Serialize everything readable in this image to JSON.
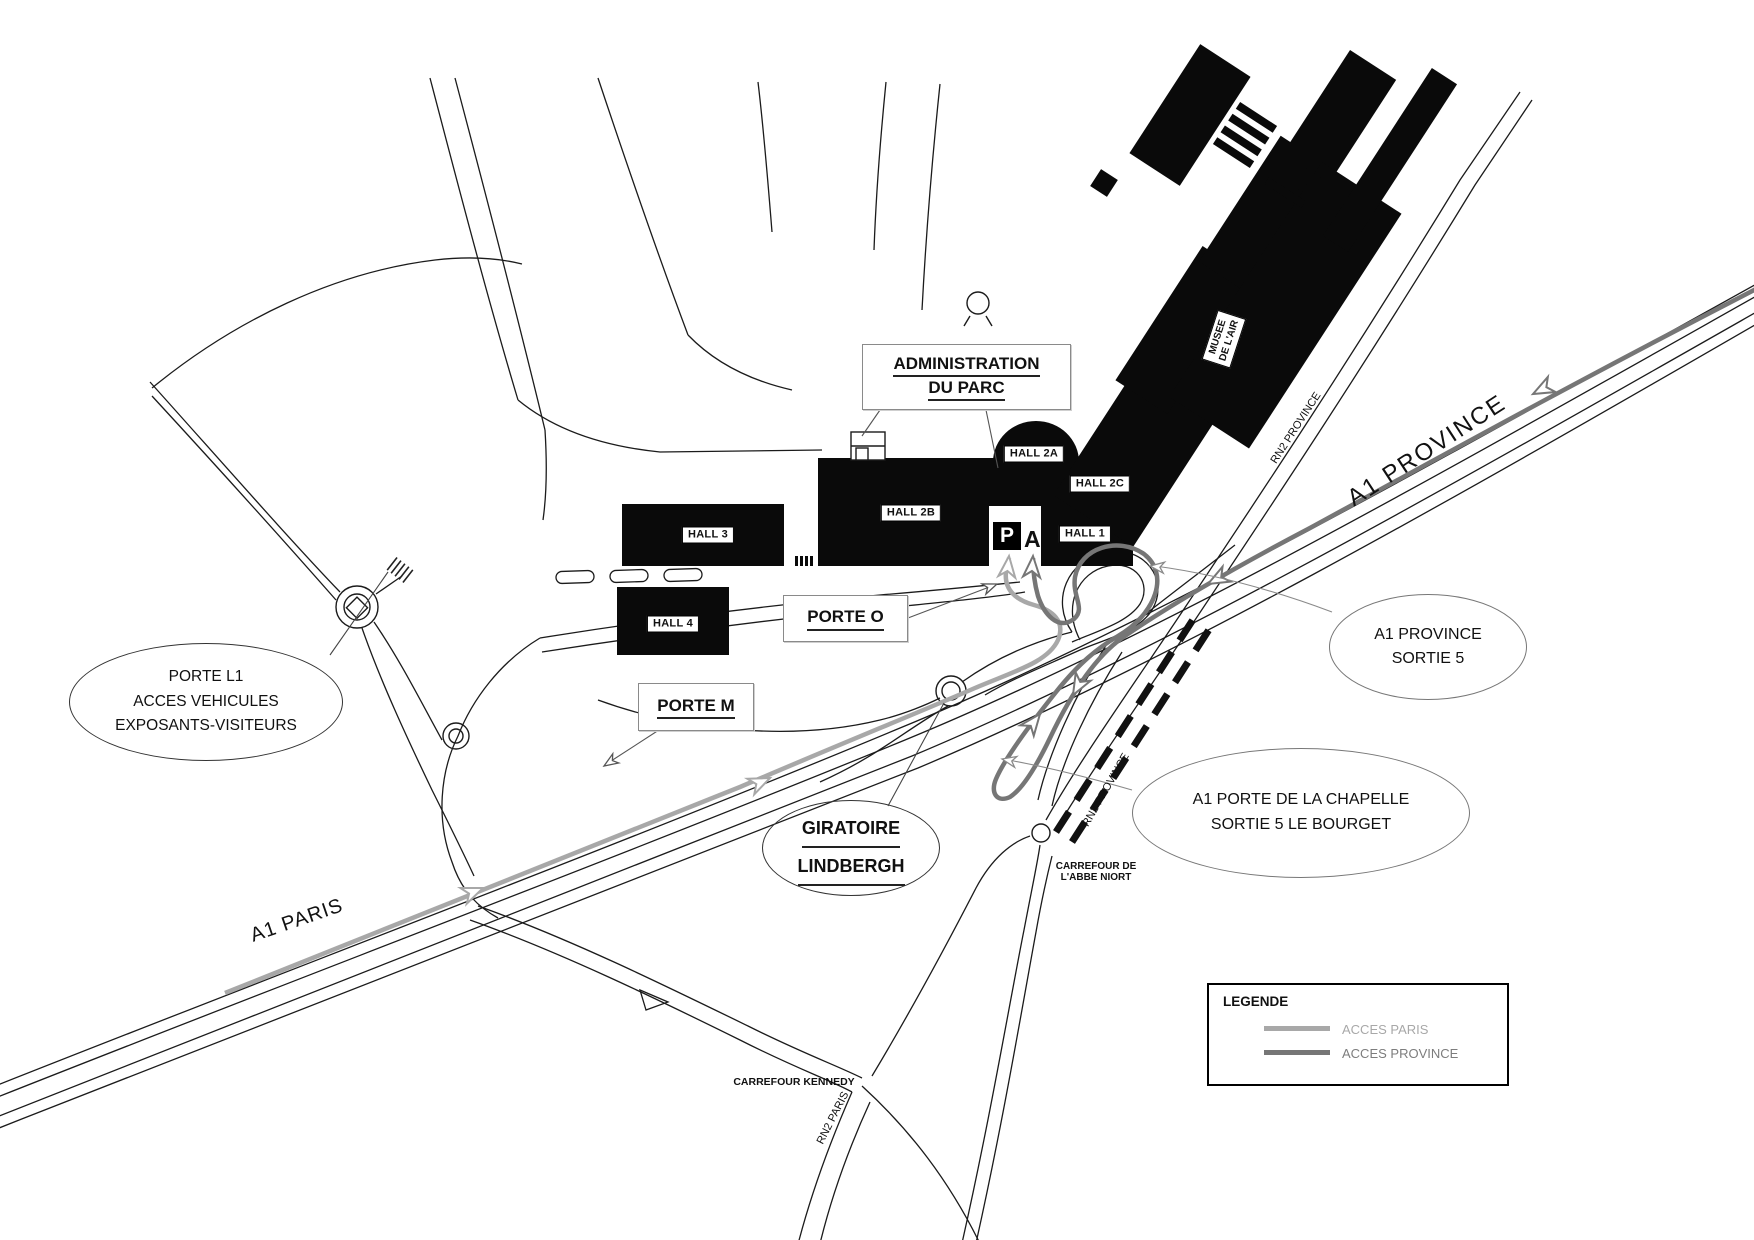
{
  "map": {
    "admin_box": {
      "line1": "ADMINISTRATION",
      "line2": "DU PARC"
    },
    "halls": {
      "hall_1": "HALL 1",
      "hall_2a": "HALL 2A",
      "hall_2b": "HALL 2B",
      "hall_2c": "HALL 2C",
      "hall_3": "HALL 3",
      "hall_4": "HALL 4"
    },
    "musee": {
      "line1": "MUSEE",
      "line2": "DE L'AIR"
    },
    "parking": {
      "p": "P",
      "zone": "A"
    },
    "porte_o": "PORTE O",
    "porte_m": "PORTE M",
    "callout_porte_l1": {
      "line1": "PORTE L1",
      "line2": "ACCES VEHICULES",
      "line3": "EXPOSANTS-VISITEURS"
    },
    "callout_giratoire": {
      "line1": "GIRATOIRE",
      "line2": "LINDBERGH"
    },
    "callout_sortie5": {
      "line1": "A1 PROVINCE",
      "line2": "SORTIE 5"
    },
    "callout_chapelle": {
      "line1": "A1 PORTE DE LA CHAPELLE",
      "line2": "SORTIE 5 LE BOURGET"
    },
    "road_labels": {
      "a1_province": "A1 PROVINCE",
      "a1_paris": "A1 PARIS",
      "rn2_province_upper": "RN2 PROVINCE",
      "rn2_province_lower": "RN2 PROVINCE",
      "rn2_paris": "RN2 PARIS",
      "carrefour_kennedy": "CARREFOUR KENNEDY",
      "carrefour_niort_line1": "CARREFOUR DE",
      "carrefour_niort_line2": "L'ABBE NIORT"
    },
    "legend": {
      "title": "LEGENDE",
      "items": [
        {
          "label": "ACCES PARIS",
          "color": "#a8a8a8"
        },
        {
          "label": "ACCES PROVINCE",
          "color": "#767676"
        }
      ]
    },
    "colors": {
      "acces_paris": "#a8a8a8",
      "acces_province": "#767676",
      "building_fill": "#0a0a0a",
      "road_line": "#1b1b1b"
    }
  }
}
